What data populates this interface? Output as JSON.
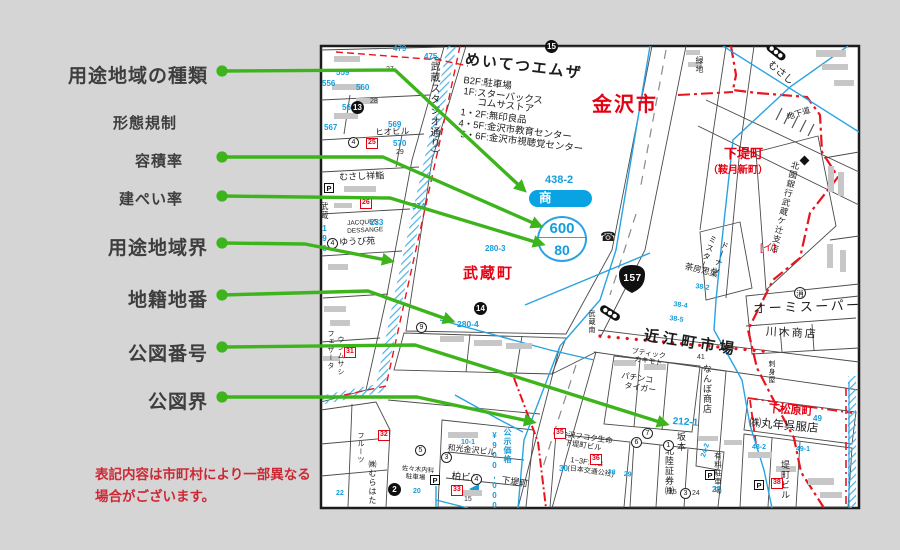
{
  "legend": {
    "items": [
      {
        "id": "yoto-chiiki-shurui",
        "label": "用途地域の種類"
      },
      {
        "id": "keitai-kisei",
        "label": "形態規制"
      },
      {
        "id": "yosekiritsu",
        "label": "容積率"
      },
      {
        "id": "kenpeiritsu",
        "label": "建ぺい率"
      },
      {
        "id": "yoto-chiiki-kai",
        "label": "用途地域界"
      },
      {
        "id": "chiseki-chiban",
        "label": "地籍地番"
      },
      {
        "id": "kozu-bango",
        "label": "公図番号"
      },
      {
        "id": "kozu-kai",
        "label": "公図界"
      }
    ],
    "disclaimer": [
      "表記内容は市町村により一部異なる",
      "場合がございます。"
    ]
  },
  "map": {
    "city": "金沢市",
    "zoning": {
      "parcel_number": "438-2",
      "district_type": "商業",
      "floor_area_ratio": "600",
      "building_coverage_ratio": "80"
    },
    "towns": {
      "musashi_cho": "武蔵町",
      "shimotsutsumi_cho": "下堤町",
      "kuratsuki_shinmachi": "（鞍月新町）",
      "shimomatsubara_cho": "下松原町",
      "shimotsutsumi_small": "下堤町"
    },
    "landmark": {
      "name": "めいてつエムザ",
      "floors": [
        "B2F:駐車場",
        "1F:スターバックス",
        "コムサストア",
        "1・2F:無印良品",
        "4・5F:金沢市教育センター",
        "5・6F:金沢市視聴覚センター"
      ]
    },
    "streets": {
      "studio_dori": "（武蔵スタジオ通り）",
      "omicho_market": "近江町市場",
      "underpass": "地下道",
      "signal_musashi": "むさし",
      "ryokuchi": "緑地",
      "signal_musashi_minami": "武蔵南",
      "musashi_vert": "武蔵"
    },
    "route_number": "157",
    "land_price": {
      "label": "公示価格",
      "value": "¥900,000"
    },
    "parcels": {
      "p479": "479",
      "p475": "475",
      "p559": "559",
      "p556": "556",
      "p560": "560",
      "p566": "566",
      "p567": "567",
      "p569": "569",
      "p570": "570",
      "p574": "574",
      "p233": "233",
      "p280_3": "280-3",
      "p280_4": "280-4",
      "p212_1": "212-1",
      "p10_1": "10-1",
      "p49": "49",
      "p48_2": "48-2",
      "p49_1": "49-1",
      "p38_2": "38-2",
      "p38_4": "38-4",
      "p38_5": "38-5",
      "p30": "30",
      "p28": "28",
      "p29": "29",
      "p23": "23",
      "p24_2": "24-2",
      "p20": "20",
      "p22": "22",
      "p196": "196"
    },
    "plot_numbers": {
      "n27": "27",
      "n28": "28",
      "n29": "29",
      "n41": "41",
      "n25": "25",
      "n24": "24",
      "n15": "15"
    },
    "pois": {
      "bank": "北國銀行武蔵ケ辻支店",
      "mister": "ミスター",
      "donut": "ドーナツ",
      "sabo": "茶房思葉",
      "omi_super": "オーミスーパー",
      "kawaki": "川木商店",
      "sashimi": "刺身屋",
      "marutoshi": "㈱丸年呉服店",
      "tsutsumi_bldg": "堤町ビル",
      "sakamoto": "坂本",
      "hokuriku_shoken": "北陸証券㈱",
      "yuryo_parking": "有料駐車場",
      "fukoku1": "金沢フコク生命",
      "fukoku2": "下堤町ビル",
      "jtb1": "1~3F:JTB",
      "jtb2": "(日本交通公社)",
      "wako": "和光金沢ビル",
      "kashiwa": "柏ビル",
      "nanbo": "なんぼ商店",
      "pachinko1": "パチンコ",
      "pachinko2": "タイガー",
      "boutique1": "ブティック",
      "boutique2": "カキモト",
      "musashi_sushi": "むさし祥鮨",
      "hio": "ヒオビル",
      "jacques1": "JACQUES",
      "jacques2": "DESSANGE",
      "yubien": "ゆうび苑",
      "murahata": "㈱むらはた",
      "fruits": "フルーツ",
      "sasaki1": "佐々木内科",
      "sasaki2": "駐車場",
      "feather1": "フェザータ",
      "feather2": "ウンムサシ"
    },
    "markers": {
      "black_circles": {
        "c13": "13",
        "c14": "14",
        "c15": "15",
        "c2": "2"
      },
      "white_circles": {
        "c1": "1",
        "c3": "3",
        "c4": "4",
        "c5": "5",
        "c6": "6",
        "c7": "7",
        "c9": "9"
      },
      "red_boxes": {
        "b25": "25",
        "b26": "26",
        "b31": "31",
        "b32": "32",
        "b33": "33",
        "b35": "35",
        "b36": "36",
        "b38": "38"
      },
      "fire_station": "消",
      "phone": "☎",
      "parking": "P",
      "mark_i": "[イ]"
    }
  }
}
